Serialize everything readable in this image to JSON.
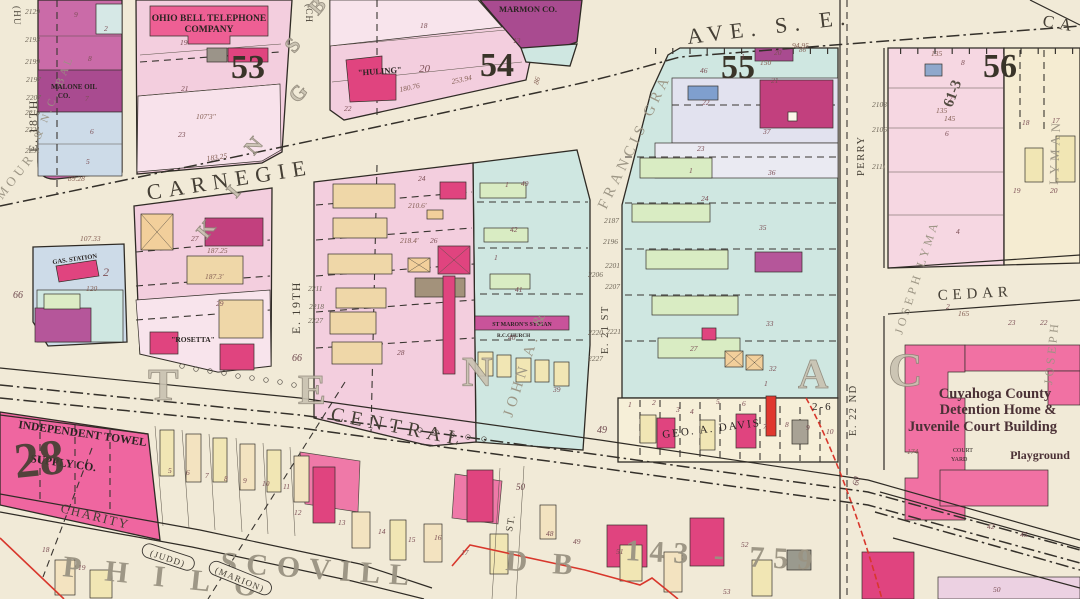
{
  "canvas": {
    "width": 1080,
    "height": 599,
    "background": "#f1ead7"
  },
  "palette": {
    "paper": "#f1ead7",
    "block_pink": "#f3cede",
    "deep_pink": "#ee5f94",
    "crimson": "#e0447f",
    "magenta_dark": "#a94b90",
    "teal": "#cfe7e1",
    "lavender": "#e2e2ef",
    "blue_grey": "#cddbe8",
    "green": "#d9ecc3",
    "buff": "#efd7a8",
    "yellow": "#f1e6b4",
    "ink": "#2f2b25",
    "red_line": "#d8372c"
  },
  "streets": {
    "carnegie": "CARNEGIE",
    "ave_se": "AVE. S. E.",
    "central": "CENTRAL",
    "charity": "CHARITY",
    "cedar": "CEDAR",
    "e18": "E. 18TH",
    "e19": "E. 19TH",
    "e21": "E. 21 ST",
    "e22": "E. 22 ND",
    "perry": "PERRY",
    "st": "ST.",
    "ca": "CA",
    "old_hu": "(HU",
    "old_ch": "(CH"
  },
  "block_numbers": {
    "b53": "53",
    "b54": "54",
    "b55": "55",
    "b56": "56"
  },
  "places": {
    "ohio_bell_1": "OHIO BELL TELEPHONE",
    "ohio_bell_2": "COMPANY",
    "marmon": "MARMON CO.",
    "malone_1": "MALONE OIL",
    "malone_2": "CO.",
    "huling": "\"HULING\"",
    "gas_station": "GAS. STATION",
    "rosetta": "\"ROSETTA\"",
    "church_1": "ST MARON'S SYRIAN",
    "church_2": "R.C.CHURCH",
    "towel_1": "INDEPENDENT TOWEL",
    "towel_2": "SUPPLY CO.",
    "davis": "GEO. A. DAVIS",
    "davis_range": "2-6",
    "det_1": "Cuyahoga County",
    "det_2": "Detention Home &",
    "det_3": "Juvenile Court Building",
    "court_1": "COURT",
    "court_2": "YARD",
    "playground": "Playground"
  },
  "plats": {
    "seymour": "MOUR",
    "ncbal": "& N.C. BAL",
    "john": "JOHN A. &",
    "francis": "FRANCIS GRA",
    "lyman_a": "JOSEPH LYMA",
    "lyman_b": "JOSEPH",
    "lyman_c": "LYMAN",
    "philo": "P H I L O",
    "scovill": "SCOVILL",
    "db": "D B",
    "deed": "143 - 759",
    "judd": "(JUDD)",
    "marion": "(MARION)"
  },
  "ghost_letters": [
    {
      "t": "K",
      "x": 206,
      "y": 240,
      "s": 21,
      "r": -50
    },
    {
      "t": "I",
      "x": 236,
      "y": 199,
      "s": 21,
      "r": -50
    },
    {
      "t": "N",
      "x": 254,
      "y": 156,
      "s": 21,
      "r": -50
    },
    {
      "t": "G",
      "x": 298,
      "y": 104,
      "s": 21,
      "r": -50
    },
    {
      "t": "S",
      "x": 294,
      "y": 54,
      "s": 21,
      "r": -50
    },
    {
      "t": "B",
      "x": 318,
      "y": 16,
      "s": 21,
      "r": -50
    },
    {
      "t": "T",
      "x": 148,
      "y": 400,
      "s": 46
    },
    {
      "t": "E",
      "x": 298,
      "y": 404,
      "s": 42
    },
    {
      "t": "N",
      "x": 462,
      "y": 386,
      "s": 42
    },
    {
      "t": "A",
      "x": 798,
      "y": 388,
      "s": 42
    },
    {
      "t": "C",
      "x": 888,
      "y": 386,
      "s": 48
    },
    {
      "t": "28",
      "x": 16,
      "y": 478,
      "s": 50,
      "r": -6,
      "c": "dark"
    },
    {
      "t": "61-3",
      "x": 952,
      "y": 108,
      "s": 15,
      "r": -70,
      "c": "dark"
    }
  ],
  "tiny_labels": [
    {
      "t": "9",
      "x": 74,
      "y": 17
    },
    {
      "t": "2",
      "x": 104,
      "y": 31
    },
    {
      "t": "8",
      "x": 88,
      "y": 61
    },
    {
      "t": "7",
      "x": 85,
      "y": 101
    },
    {
      "t": "6",
      "x": 90,
      "y": 134
    },
    {
      "t": "5",
      "x": 86,
      "y": 164
    },
    {
      "t": "89.28",
      "x": 68,
      "y": 181,
      "c": "dim"
    },
    {
      "t": "2129",
      "x": 25,
      "y": 14,
      "c": "house"
    },
    {
      "t": "2193",
      "x": 25,
      "y": 42,
      "c": "house"
    },
    {
      "t": "2199",
      "x": 25,
      "y": 64,
      "c": "house"
    },
    {
      "t": "2197",
      "x": 26,
      "y": 82,
      "c": "house"
    },
    {
      "t": "2207",
      "x": 26,
      "y": 100,
      "c": "house"
    },
    {
      "t": "2219",
      "x": 25,
      "y": 115,
      "c": "house"
    },
    {
      "t": "2221",
      "x": 25,
      "y": 132,
      "c": "house"
    },
    {
      "t": "2231",
      "x": 25,
      "y": 153,
      "c": "house"
    },
    {
      "t": "19",
      "x": 180,
      "y": 45
    },
    {
      "t": "21",
      "x": 181,
      "y": 91
    },
    {
      "t": "23",
      "x": 178,
      "y": 137
    },
    {
      "t": "107'3\"",
      "x": 196,
      "y": 119,
      "c": "dim"
    },
    {
      "t": "183.25",
      "x": 207,
      "y": 161,
      "r": -8,
      "c": "dim"
    },
    {
      "t": "18",
      "x": 420,
      "y": 28
    },
    {
      "t": "13",
      "x": 513,
      "y": 43
    },
    {
      "t": "20",
      "x": 419,
      "y": 72,
      "s": 11
    },
    {
      "t": "22",
      "x": 344,
      "y": 111
    },
    {
      "t": "180.76",
      "x": 400,
      "y": 92,
      "r": -12,
      "c": "dim"
    },
    {
      "t": "253.94",
      "x": 452,
      "y": 84,
      "r": -12,
      "c": "dim"
    },
    {
      "t": "86",
      "x": 538,
      "y": 85,
      "r": -72,
      "c": "dim"
    },
    {
      "t": "46",
      "x": 700,
      "y": 73
    },
    {
      "t": "1",
      "x": 741,
      "y": 59
    },
    {
      "t": "150",
      "x": 760,
      "y": 65,
      "c": "dim"
    },
    {
      "t": "20",
      "x": 774,
      "y": 55
    },
    {
      "t": "21",
      "x": 771,
      "y": 83
    },
    {
      "t": "22",
      "x": 702,
      "y": 105
    },
    {
      "t": "37",
      "x": 763,
      "y": 134
    },
    {
      "t": "36",
      "x": 768,
      "y": 175
    },
    {
      "t": "23",
      "x": 697,
      "y": 151
    },
    {
      "t": "1",
      "x": 689,
      "y": 173
    },
    {
      "t": "24",
      "x": 701,
      "y": 201
    },
    {
      "t": "35",
      "x": 759,
      "y": 230
    },
    {
      "t": "94.95",
      "x": 792,
      "y": 48,
      "c": "dim"
    },
    {
      "t": "86",
      "x": 799,
      "y": 52,
      "s": 7,
      "c": "dim"
    },
    {
      "t": "27",
      "x": 690,
      "y": 351
    },
    {
      "t": "33",
      "x": 766,
      "y": 326
    },
    {
      "t": "32",
      "x": 769,
      "y": 371
    },
    {
      "t": "1",
      "x": 764,
      "y": 386
    },
    {
      "t": "1",
      "x": 505,
      "y": 187
    },
    {
      "t": "49",
      "x": 521,
      "y": 186
    },
    {
      "t": "42",
      "x": 510,
      "y": 232
    },
    {
      "t": "1",
      "x": 494,
      "y": 260
    },
    {
      "t": "41",
      "x": 515,
      "y": 292
    },
    {
      "t": "40",
      "x": 508,
      "y": 340
    },
    {
      "t": "39",
      "x": 553,
      "y": 392
    },
    {
      "t": "2187",
      "x": 604,
      "y": 223,
      "c": "house"
    },
    {
      "t": "2196",
      "x": 603,
      "y": 244,
      "c": "house"
    },
    {
      "t": "2201",
      "x": 605,
      "y": 268,
      "c": "house"
    },
    {
      "t": "2206",
      "x": 588,
      "y": 277,
      "c": "house"
    },
    {
      "t": "2207",
      "x": 605,
      "y": 289,
      "c": "house"
    },
    {
      "t": "2220",
      "x": 588,
      "y": 335,
      "c": "house"
    },
    {
      "t": "2221",
      "x": 606,
      "y": 334,
      "c": "house"
    },
    {
      "t": "2227",
      "x": 588,
      "y": 361,
      "c": "house"
    },
    {
      "t": "2211",
      "x": 308,
      "y": 291,
      "c": "house"
    },
    {
      "t": "2218",
      "x": 309,
      "y": 309,
      "c": "house"
    },
    {
      "t": "2227",
      "x": 308,
      "y": 323,
      "c": "house"
    },
    {
      "t": "24",
      "x": 418,
      "y": 181
    },
    {
      "t": "210.6'",
      "x": 408,
      "y": 208,
      "c": "dim"
    },
    {
      "t": "26",
      "x": 430,
      "y": 243
    },
    {
      "t": "218.4'",
      "x": 400,
      "y": 243,
      "c": "dim"
    },
    {
      "t": "28",
      "x": 397,
      "y": 355
    },
    {
      "t": "27",
      "x": 191,
      "y": 241
    },
    {
      "t": "187.25",
      "x": 207,
      "y": 253,
      "c": "dim"
    },
    {
      "t": "29",
      "x": 216,
      "y": 306
    },
    {
      "t": "187.3'",
      "x": 205,
      "y": 279,
      "c": "dim"
    },
    {
      "t": "107.33",
      "x": 80,
      "y": 241,
      "c": "dim"
    },
    {
      "t": "120",
      "x": 86,
      "y": 291,
      "c": "dim"
    },
    {
      "t": "2",
      "x": 103,
      "y": 276,
      "s": 12
    },
    {
      "t": "135",
      "x": 931,
      "y": 56,
      "c": "dim"
    },
    {
      "t": "8",
      "x": 961,
      "y": 65
    },
    {
      "t": "7",
      "x": 949,
      "y": 101
    },
    {
      "t": "135",
      "x": 936,
      "y": 113,
      "c": "dim"
    },
    {
      "t": "145",
      "x": 944,
      "y": 121,
      "c": "dim"
    },
    {
      "t": "6",
      "x": 945,
      "y": 136
    },
    {
      "t": "18",
      "x": 1022,
      "y": 125
    },
    {
      "t": "17",
      "x": 1052,
      "y": 123
    },
    {
      "t": "19",
      "x": 1013,
      "y": 193
    },
    {
      "t": "20",
      "x": 1050,
      "y": 193
    },
    {
      "t": "2103",
      "x": 872,
      "y": 107,
      "c": "house"
    },
    {
      "t": "2106",
      "x": 872,
      "y": 132,
      "c": "house"
    },
    {
      "t": "2111",
      "x": 872,
      "y": 169,
      "c": "house"
    },
    {
      "t": "4",
      "x": 956,
      "y": 234
    },
    {
      "t": "2",
      "x": 946,
      "y": 309
    },
    {
      "t": "165",
      "x": 958,
      "y": 316,
      "c": "dim"
    },
    {
      "t": "23",
      "x": 1008,
      "y": 325
    },
    {
      "t": "22",
      "x": 1040,
      "y": 325
    },
    {
      "t": "174",
      "x": 907,
      "y": 454,
      "c": "dim"
    },
    {
      "t": "42",
      "x": 987,
      "y": 529
    },
    {
      "t": "45",
      "x": 1020,
      "y": 537
    },
    {
      "t": "50",
      "x": 993,
      "y": 592
    },
    {
      "t": "1",
      "x": 628,
      "y": 407
    },
    {
      "t": "2",
      "x": 652,
      "y": 405
    },
    {
      "t": "3",
      "x": 676,
      "y": 412
    },
    {
      "t": "4",
      "x": 690,
      "y": 414
    },
    {
      "t": "5",
      "x": 716,
      "y": 404
    },
    {
      "t": "6",
      "x": 742,
      "y": 406
    },
    {
      "t": "7",
      "x": 763,
      "y": 429
    },
    {
      "t": "8",
      "x": 785,
      "y": 427
    },
    {
      "t": "9",
      "x": 806,
      "y": 430
    },
    {
      "t": "10",
      "x": 826,
      "y": 434
    },
    {
      "t": "49",
      "x": 597,
      "y": 433,
      "s": 10,
      "c": "num"
    },
    {
      "t": "50",
      "x": 516,
      "y": 490,
      "s": 9,
      "c": "num"
    },
    {
      "t": "66",
      "x": 13,
      "y": 298,
      "s": 10,
      "c": "num"
    },
    {
      "t": "66",
      "x": 292,
      "y": 361,
      "s": 10,
      "c": "num"
    },
    {
      "t": "60",
      "x": 858,
      "y": 486,
      "r": -78,
      "s": 9,
      "c": "num"
    },
    {
      "t": "5",
      "x": 168,
      "y": 473
    },
    {
      "t": "6",
      "x": 186,
      "y": 475
    },
    {
      "t": "7",
      "x": 205,
      "y": 478
    },
    {
      "t": "8",
      "x": 224,
      "y": 481
    },
    {
      "t": "9",
      "x": 243,
      "y": 483
    },
    {
      "t": "10",
      "x": 262,
      "y": 486
    },
    {
      "t": "11",
      "x": 283,
      "y": 489
    },
    {
      "t": "12",
      "x": 294,
      "y": 515
    },
    {
      "t": "13",
      "x": 338,
      "y": 525
    },
    {
      "t": "14",
      "x": 378,
      "y": 534
    },
    {
      "t": "15",
      "x": 408,
      "y": 542
    },
    {
      "t": "16",
      "x": 434,
      "y": 540
    },
    {
      "t": "17",
      "x": 461,
      "y": 555
    },
    {
      "t": "18",
      "x": 42,
      "y": 552
    },
    {
      "t": "19",
      "x": 78,
      "y": 570
    },
    {
      "t": "48",
      "x": 546,
      "y": 536
    },
    {
      "t": "49",
      "x": 573,
      "y": 544
    },
    {
      "t": "51",
      "x": 616,
      "y": 554
    },
    {
      "t": "52",
      "x": 741,
      "y": 547
    },
    {
      "t": "53",
      "x": 723,
      "y": 594
    }
  ]
}
